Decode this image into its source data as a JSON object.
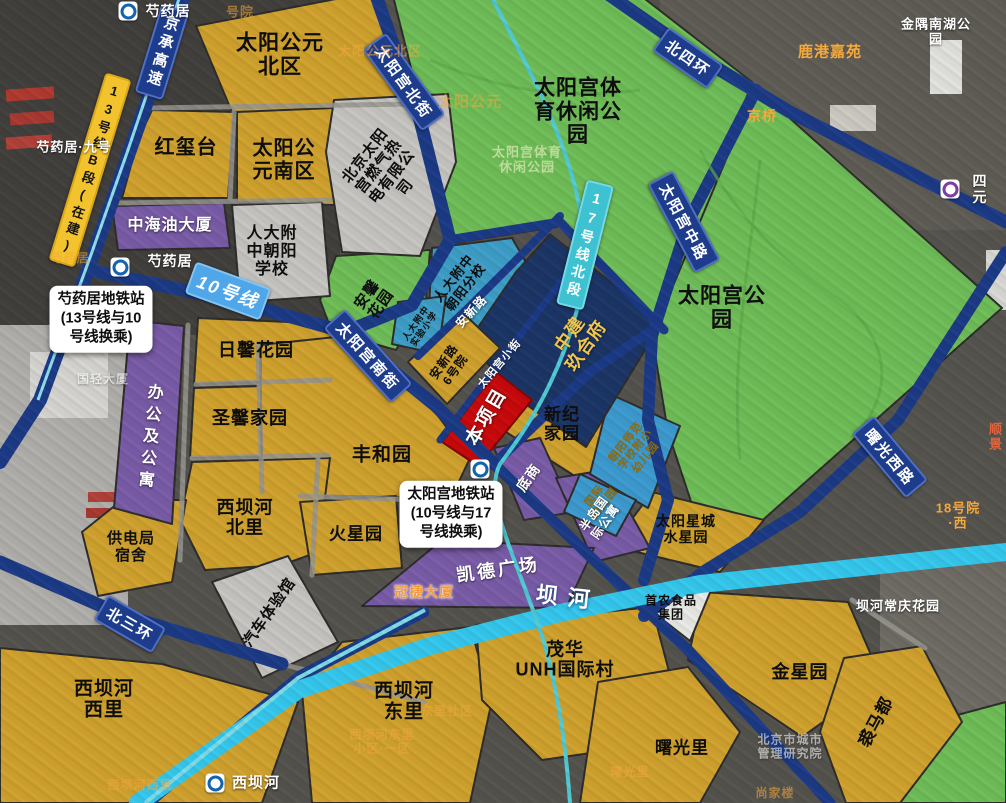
{
  "legend_colors": {
    "residential_gold": "#D0A22E",
    "park_green": "#6FBE58",
    "office_purple": "#7A5CA8",
    "school_blue": "#3E9FC8",
    "navy_block": "#1B3566",
    "project_red": "#C9090B",
    "road_blue": "#1C3B86",
    "river_cyan": "#35C8EE",
    "line10_banner": "#4FA6E8",
    "line17_banner": "#3EC2D2",
    "line13_banner": "#F2C32C"
  },
  "regions": {
    "sun_palace_north": "太阳公元\n北区",
    "hongxitai": "红玺台",
    "sun_palace_south": "太阳公\n元南区",
    "zhonghaiyou": "中海油大厦",
    "rdfz_chaoyang_school": "人大附\n中朝阳\n学校",
    "gas_power": "北京太阳\n宫燃气热\n电有限公\n司",
    "sports_park": "太阳宫体\n育休闲公\n园",
    "sun_palace_park": "太阳宫公\n园",
    "anxin_garden": "安馨\n花园",
    "rdfz_chaoyang_branch": "人大附中\n朝阳分校",
    "rdfz_experimental": "人大附中\n实验小学",
    "zhongjian_jiuhefu": "中建\n玖合府",
    "anxinlu_yard6": "安新路\n6号院",
    "project_site": "本项目",
    "xinji_home": "新纪\n家园",
    "chaoyang_normal_kindergarten": "朝阳师范\n学校附小\n幼儿园",
    "international_kindergarten": "国际\n幼儿园",
    "sun_star_city": "太阳星城\n水星园",
    "ground_shops": "底商",
    "peninsula_apartment": "半岛国\n际公寓",
    "capitaland_plaza": "凯德广场",
    "rixin_garden": "日馨花园",
    "shengxin_home": "圣馨家园",
    "office_and_apartment": "办公及公寓",
    "fengheyuan": "丰和园",
    "xibahe_north": "西坝河\n北里",
    "power_bureau_dorm": "供电局\n宿舍",
    "mars_garden": "火星园",
    "auto_experience_hall": "汽车体验馆",
    "xibahe_west": "西坝河\n西里",
    "xibahe_east": "西坝河\n东里",
    "maohua_unh": "茂华\nUNH国际村",
    "shounong_food_group": "首农食品\n集团",
    "jinxing_garden": "金星园",
    "shuguangli": "曙光里",
    "qiumadu": "裘马都"
  },
  "roads": {
    "jingcheng_expressway": "京承高速",
    "line13_b_section": "13号线B段(在建)",
    "line10": "10号线",
    "line17_north_section": "17号线北段",
    "taiyanggong_north_st": "太阳宫北街",
    "taiyanggong_south_st": "太阳宫南街",
    "taiyanggong_middle_rd": "太阳宫中路",
    "anxin_rd": "安新路",
    "taiyanggong_small_st": "太阳宫小街",
    "north_4th_ring": "北四环",
    "north_3rd_ring": "北三环",
    "shuguang_west_rd": "曙光西路",
    "bahe_river": "坝河"
  },
  "stations": {
    "shaoyaoju": "芍药居",
    "shaoyaoju_interchange_note": "芍药居地铁站\n(13号线与10\n号线换乘)",
    "taiyanggong_interchange_note": "太阳宫地铁站\n(10号线与17\n号线换乘)",
    "xibahe": "西坝河",
    "siyuan": "四元"
  },
  "landmarks": {
    "shaoyaoju_no9": "芍药居·九号",
    "jinyu_nanhu_park": "金隅南湖公园",
    "lugang_jiayuan": "鹿港嘉苑",
    "jingqiao": "京桥",
    "guanjie_tower": "冠捷大厦",
    "bahe_changqing_garden": "坝河常庆花园",
    "yard18_west": "18号院·西",
    "shunjing": "顺景",
    "guoqing_tower": "国轻大厦",
    "sun_palace_faint": "太阳公元",
    "sun_palace_north_faint": "太阳公元北区",
    "yard_faint": "号院",
    "sports_park_faint": "太阳宫体育\n休闲公园",
    "dongli_community": "东里社区",
    "dongli_block1": "西坝河东里\n小区·一区",
    "shangjialou": "尚家楼",
    "city_mgmt_institute": "北京市城市\n管理研究院",
    "shuguangli_faint": "曙光里",
    "xibahe_west_faint": "西坝河西里",
    "shaoyaoju_faint": "芍药居"
  }
}
